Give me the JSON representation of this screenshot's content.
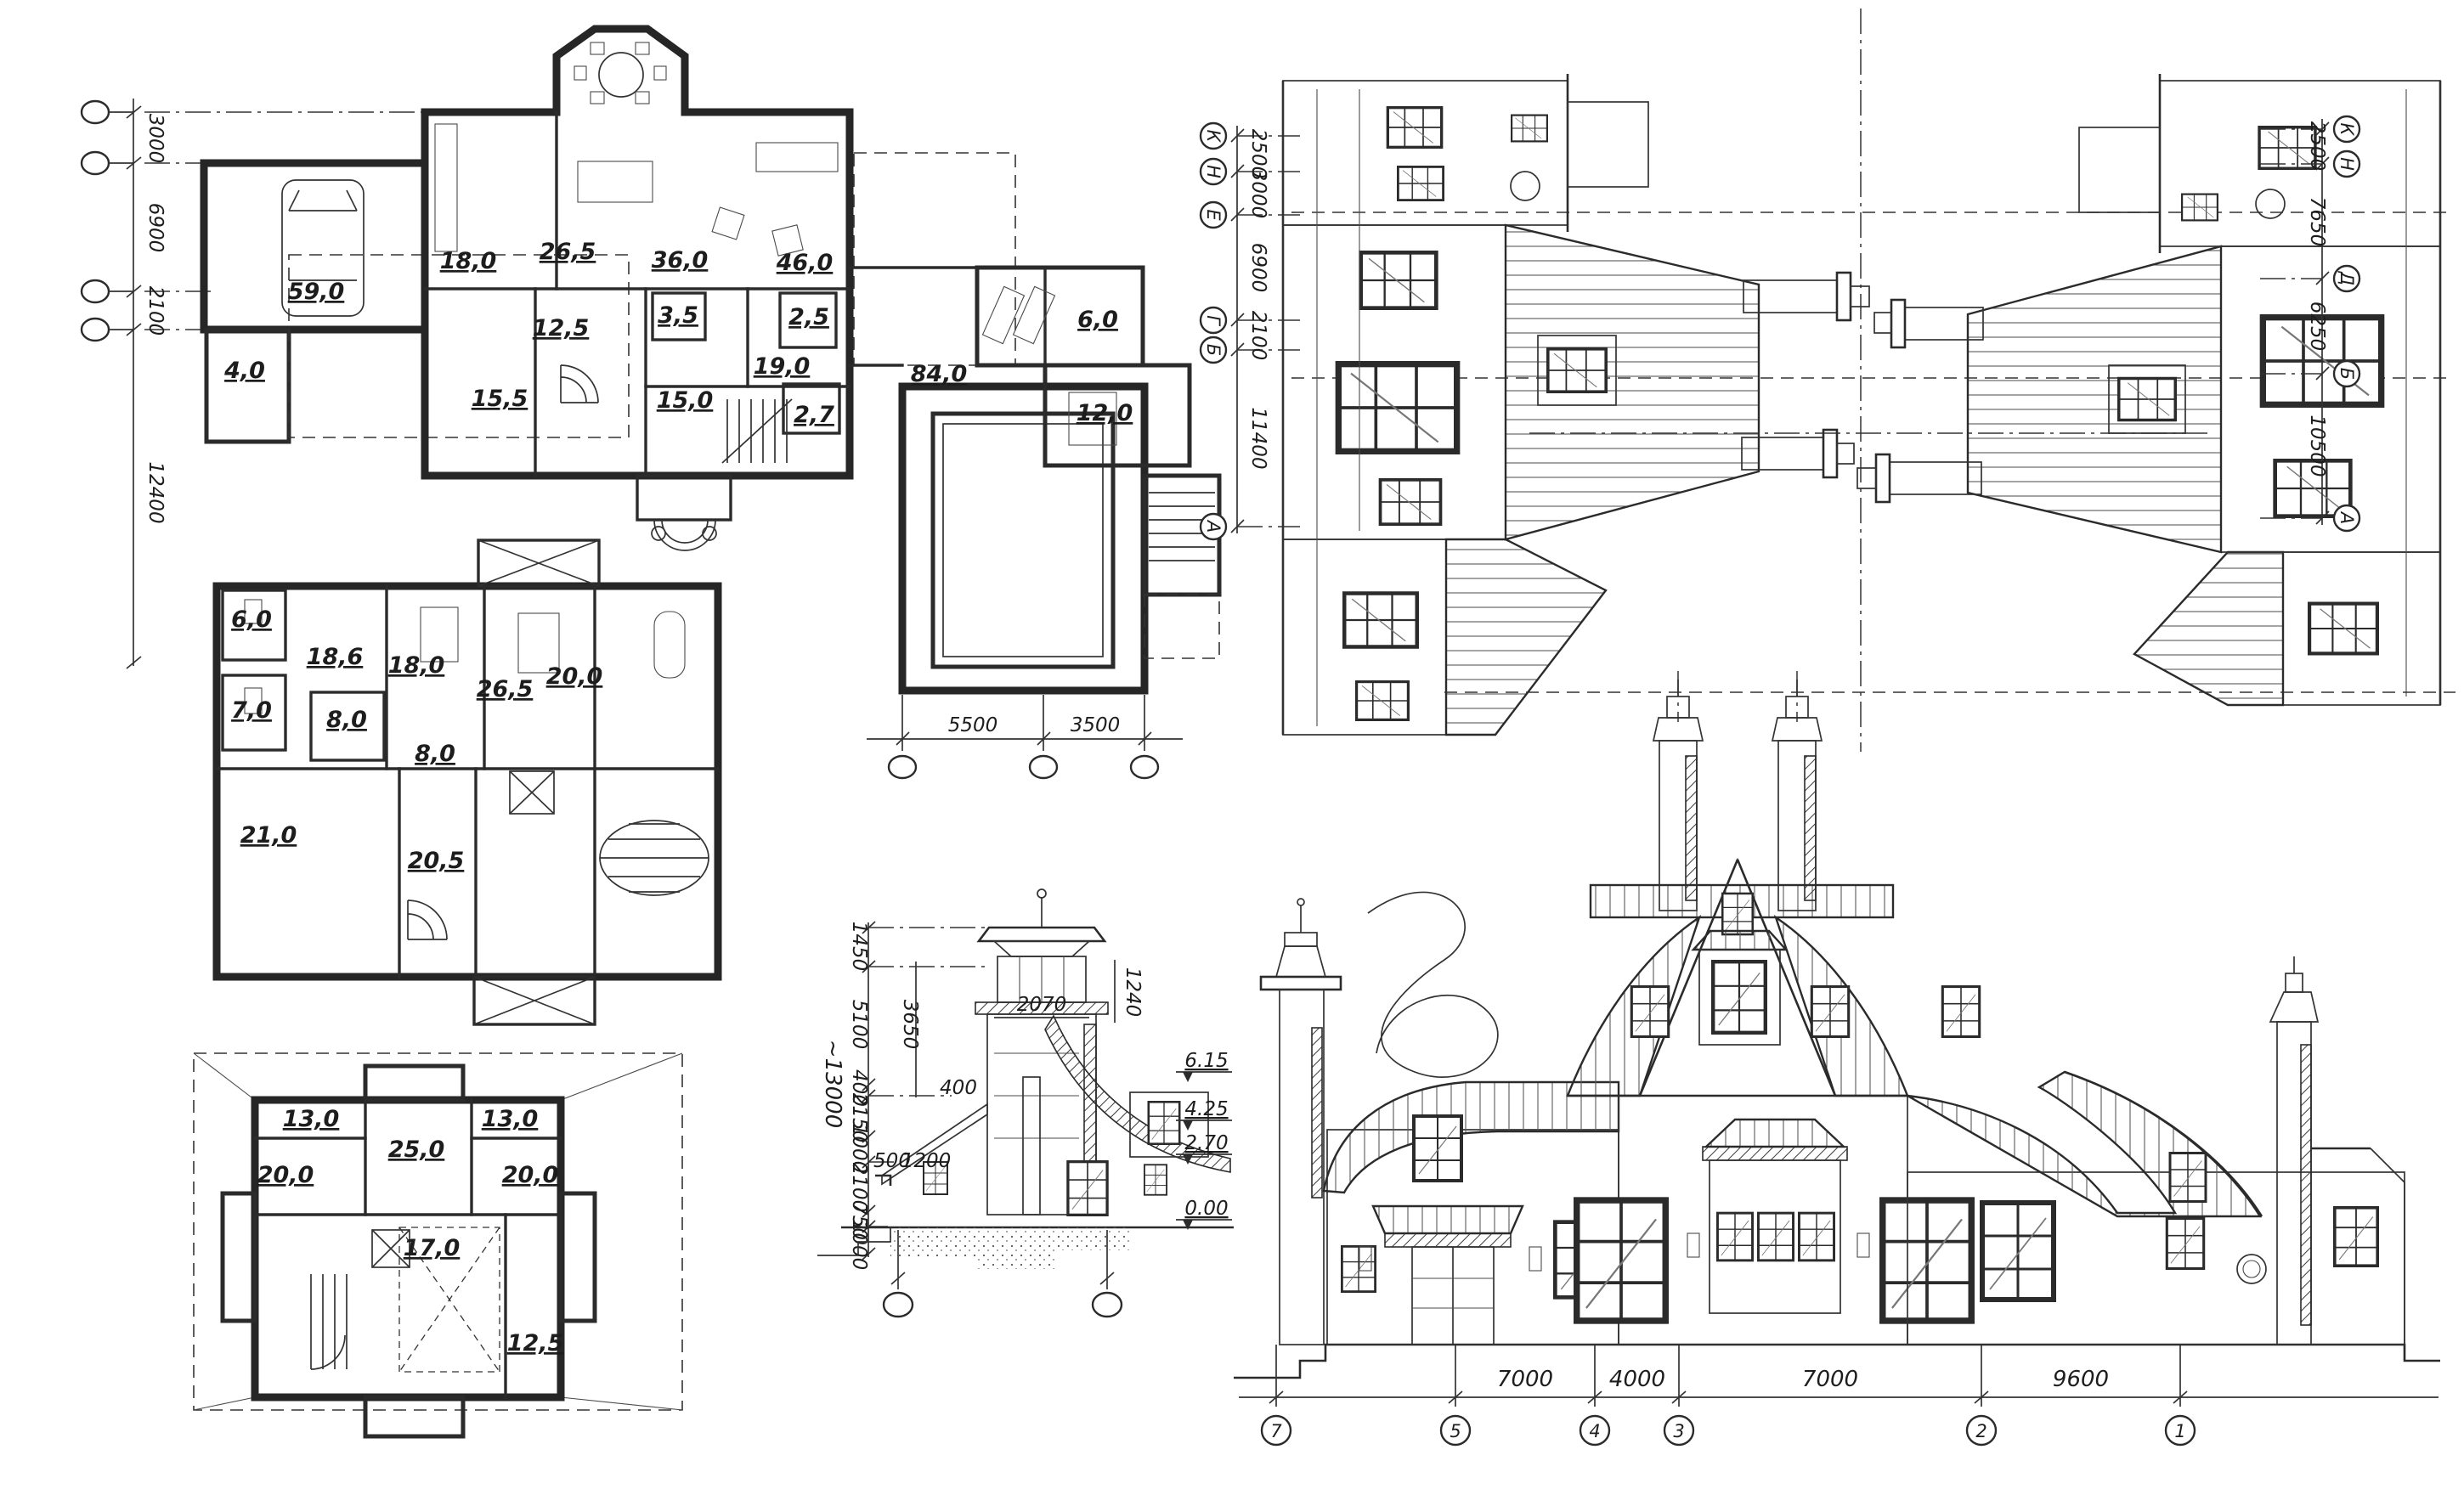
{
  "drawing": {
    "ink": "#2a2a2a",
    "paper": "#ffffff"
  },
  "ground_floor_plan": {
    "axis_dims": [
      "3000",
      "6900",
      "2100",
      "12400"
    ],
    "bottom_dims": [
      "5500",
      "3500"
    ],
    "rooms": {
      "porch": "4,0",
      "garage": "59,0",
      "kitchen": "18,0",
      "dining": "26,5",
      "living": "36,0",
      "terrace": "46,0",
      "hall": "12,5",
      "pantry": "3,5",
      "wc": "2,5",
      "study": "15,5",
      "stair_hall": "15,0",
      "corridor": "19,0",
      "wc_small": "2,7",
      "pool_hall": "84,0",
      "guest": "12,0",
      "sauna": "6,0"
    }
  },
  "second_floor_plan": {
    "rooms": {
      "wc": "6,0",
      "bath": "7,0",
      "bedroom_1": "18,6",
      "bedroom_2": "18,0",
      "bedroom_3": "26,5",
      "bath_2": "20,0",
      "hall_1": "8,0",
      "hall_2": "8,0",
      "bedroom_4": "21,0",
      "hall_3": "20,5"
    }
  },
  "attic_floor_plan": {
    "rooms": {
      "room_left": "13,0",
      "room_right": "13,0",
      "studio": "25,0",
      "bedroom_left": "20,0",
      "bedroom_right": "20,0",
      "hall": "17,0",
      "store": "12,5"
    }
  },
  "side_elevations": {
    "left_axis": {
      "letters": [
        "К",
        "Н",
        "Е",
        "Г",
        "Б",
        "А"
      ],
      "dims": [
        "2500",
        "3000",
        "6900",
        "2100",
        "11400"
      ]
    },
    "right_axis": {
      "letters": [
        "К",
        "Н",
        "Д",
        "Б",
        "А"
      ],
      "dims": [
        "2500",
        "7650",
        "6250",
        "10500"
      ]
    }
  },
  "tower_section": {
    "chain_dims": [
      "1450",
      "5100",
      "400",
      "2150",
      "1000",
      "2100",
      "750",
      "1000"
    ],
    "overall": "~13000",
    "inner_dims": {
      "tower_width": "2070",
      "parapet": "1240",
      "shaft": "3650",
      "ledge": "400",
      "plinth": "500",
      "offset": "1200"
    },
    "levels": [
      "6.15",
      "4.25",
      "2.70",
      "0.00"
    ]
  },
  "front_elevation": {
    "axis_bubbles": [
      "7",
      "5",
      "4",
      "3",
      "2",
      "1"
    ],
    "dims": [
      "7000",
      "4000",
      "7000",
      "9600"
    ]
  }
}
